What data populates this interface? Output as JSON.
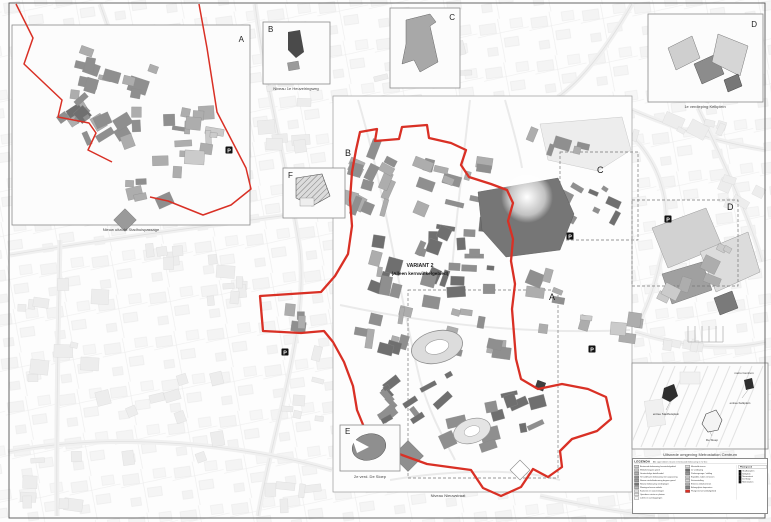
{
  "map_title": {
    "line1": "VARIANT 2",
    "line2": "(Alleen kernwinkelgebied)"
  },
  "region_letters": {
    "a": "A",
    "b": "B",
    "c": "C",
    "d": "D"
  },
  "insets": {
    "a": {
      "letter": "A",
      "caption": "Nieuw uitzicht Stadhuispassage"
    },
    "b": {
      "letter": "B",
      "caption": "Niveau 1e Heuvelringweg"
    },
    "c": {
      "letter": "C"
    },
    "d": {
      "letter": "D",
      "caption": "1e verdieping Kelkplein"
    },
    "e": {
      "letter": "E",
      "caption": "2e verd. De Sloep"
    },
    "f": {
      "letter": "F"
    },
    "metro": {
      "caption": "Uitsnede omgeving Metrostation Centrum",
      "labels": [
        "entree Stadhuisplein",
        "metro Centrum",
        "De Sloep",
        "entree Kelkplein"
      ]
    }
  },
  "main_map": {
    "caption": "Niveau Nieuwstraat",
    "parking_label": "P"
  },
  "legend": {
    "title": "LEGENDA",
    "note": "Alle oppervlakten nieuwe en bestaande bebouwing in m2 bvo",
    "left": [
      {
        "color": "#d2d2d2",
        "label": "Bestaande bebouwing kernwinkelgebied"
      },
      {
        "color": "#c2c2c2",
        "label": "Winkels begane grond"
      },
      {
        "color": "#b2b2b2",
        "label": "Grootschalige detailhandel"
      },
      {
        "color": "#8e8e8e",
        "label": "Te handhaven bebouwing met aanpassing"
      },
      {
        "color": "#9e9e9e",
        "label": "Nieuwe winkelbebouwing begane grond"
      },
      {
        "color": "#787878",
        "label": "Nieuwe bebouwing verdiepingen"
      },
      {
        "color": "#bcbcbc",
        "label": "Woningen boven winkels"
      },
      {
        "color": "#dadada",
        "label": "Kantoren en voorzieningen"
      },
      {
        "color": "#ececec",
        "label": "Openbare ruimte en pleinen"
      },
      {
        "color": "#f4f4f4",
        "label": "Luifels en overkappingen"
      }
    ],
    "right": [
      {
        "color": "#e2e2e2",
        "label": "Maaiveld niveau"
      },
      {
        "color": "#6e6e6e",
        "label": "1e verdieping"
      },
      {
        "color": "#989898",
        "label": "Parkeergarage / stalling"
      },
      {
        "color": "#c6c6c6",
        "label": "Expeditie, laden en lossen"
      },
      {
        "color": "#d8d8d8",
        "label": "Fietsenstalling"
      },
      {
        "color": "#aaaaaa",
        "label": "Entrees winkelcentrum"
      },
      {
        "color": "#848484",
        "label": "Belangrijkste looproutes"
      },
      {
        "color": "#d93025",
        "label": "Plangrens kernwinkelgebied"
      }
    ],
    "platte": {
      "title": "Plattegrond",
      "items": [
        "Stadhuisplein",
        "Kelkplein",
        "Nieuwstraat",
        "De Sloep",
        "Metrostation"
      ]
    }
  },
  "colors": {
    "boundary_red": "#d93025",
    "building_shades": [
      "#6f6f6f",
      "#8f8f8f",
      "#adadad",
      "#cbcbcb"
    ],
    "faint": "#ededed"
  }
}
